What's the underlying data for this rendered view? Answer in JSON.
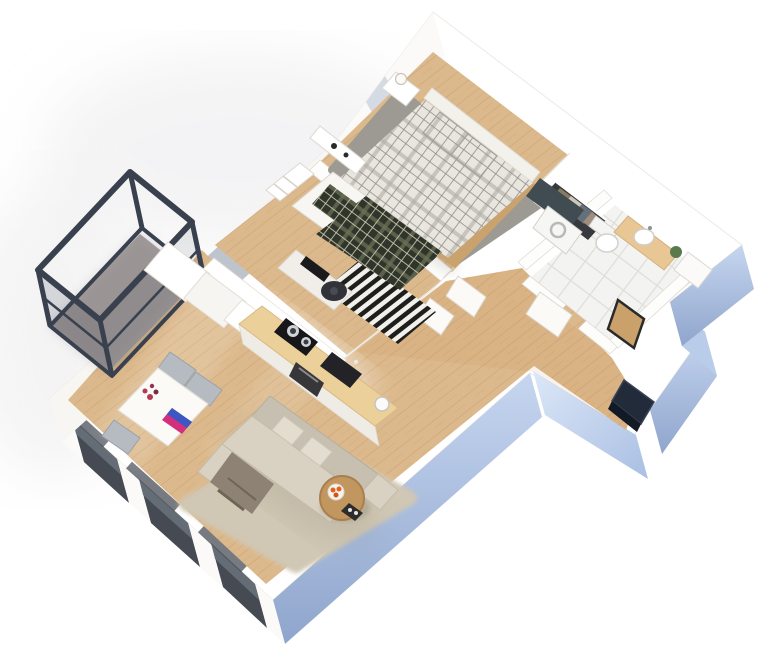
{
  "scene": {
    "description": "3D isometric apartment floor plan render",
    "view": "isometric-top-down",
    "rooms": [
      {
        "id": "master-bedroom",
        "furniture": [
          "double-bed-plaid-duvet",
          "two-plaid-pillows",
          "white-headboard",
          "nightstand-with-lamp-left",
          "nightstand-with-lamp-right",
          "pink-storage-box",
          "gray-area-rug",
          "wall-console-shelf",
          "open-wardrobe-with-clothes",
          "window"
        ]
      },
      {
        "id": "bedroom-2",
        "furniture": [
          "single-bed-white-mattress",
          "dark-plaid-blanket",
          "dark-plaid-pillow",
          "black-white-striped-rug",
          "desk-with-monitor",
          "office-chair",
          "wall-shelf-unit"
        ]
      },
      {
        "id": "bathroom",
        "furniture": [
          "toilet",
          "washing-machine",
          "dark-laundry-panel",
          "wood-vanity-shelf",
          "white-basin",
          "potted-plant",
          "white-cabinet",
          "leaning-mirror",
          "door-leaf"
        ]
      },
      {
        "id": "kitchen",
        "furniture": [
          "tall-cabinet-columns",
          "wood-counter",
          "black-cooktop-with-pots",
          "dark-sink",
          "oven",
          "kettle",
          "under-cabinet-light"
        ]
      },
      {
        "id": "dining-area",
        "furniture": [
          "white-dining-table",
          "flower-bouquet",
          "colorful-laptop",
          "three-gray-chairs"
        ]
      },
      {
        "id": "living-room",
        "furniture": [
          "beige-corner-sofa",
          "cushions",
          "draped-blanket",
          "shag-rug",
          "round-wood-coffee-table",
          "bowl-of-orange-flowers",
          "dark-tray"
        ]
      },
      {
        "id": "hallway",
        "furniture": [
          "open-door-leaves",
          "wood-floor"
        ]
      },
      {
        "id": "entry",
        "furniture": [
          "navy-entrance-door"
        ]
      },
      {
        "id": "balcony",
        "furniture": [
          "black-steel-railing-cage",
          "gray-concrete-floor"
        ]
      }
    ]
  },
  "palette": {
    "wall_white": "#ffffff",
    "wall_shade": "#e9e4dc",
    "wall_stroke": "#e2dcd2",
    "wood_base": "#dcb98c",
    "wood_grain": "#c9a274",
    "hall_tint": "#c08040",
    "rug_gray": "#9c9a93",
    "plaid_light_base": "#e9e6e0",
    "plaid_light_line": "#8f8d85",
    "plaid_light_band": "#b1aea6",
    "plaid_dark_base": "#30352b",
    "plaid_dark_line": "#d6d2b8",
    "plaid_dark_band": "#6d7257",
    "stripe_dark": "#1e1e1c",
    "stripe_light": "#f2f0ea",
    "tile_base": "#f3f3f1",
    "tile_line": "#deddd8",
    "mattress_white": "#f7f6f2",
    "bed_frame_wood": "#c9a26e",
    "headboard_white": "#f3f1ec",
    "sofa_beige": "#d9d2c3",
    "sofa_shade": "#c7c0b0",
    "pillow_light": "#e3ddcf",
    "blanket_taupe": "#8d8274",
    "shag_rug": "#d0c7b4",
    "coffee_table_wood": "#c2965f",
    "flowers_orange": "#e2641c",
    "bowl_white": "#f6f4ef",
    "dining_table_white": "#fbfaf7",
    "chair_gray": "#b5bbc1",
    "flowers_red": "#b43a52",
    "laptop_pink": "#d2307e",
    "laptop_blue": "#3a57c4",
    "counter_wood": "#ecd09a",
    "cabinet_white": "#f3f0eb",
    "cooktop_black": "#17171a",
    "pot_steel": "#cfd4d8",
    "oven_dark": "#37373a",
    "sink_black": "#232327",
    "balcony_frame": "#3a414e",
    "balcony_floor": "#a39d9d",
    "window_dark": "#454a53",
    "glass_blue": "#cdd5e0",
    "door_navy": "#222b39",
    "face_blue_light": "#c6d6f0",
    "face_blue": "#a9bfe2",
    "face_blue_deep": "#8fa5cc",
    "toilet_white": "#ffffff",
    "fixture_stroke": "#d2d2cc",
    "vanity_wood": "#e8c795",
    "plant_green": "#5a7a4b",
    "pink_accent": "#e7b6c3",
    "washer_panel": "#414b52",
    "wardrobe_dark": "#36393e",
    "clothes_tan": "#8a7a5f",
    "clothes_cream": "#cfc8ba",
    "clothes_slate": "#66707a",
    "monitor_black": "#1b1b1d",
    "office_chair": "#323338"
  }
}
